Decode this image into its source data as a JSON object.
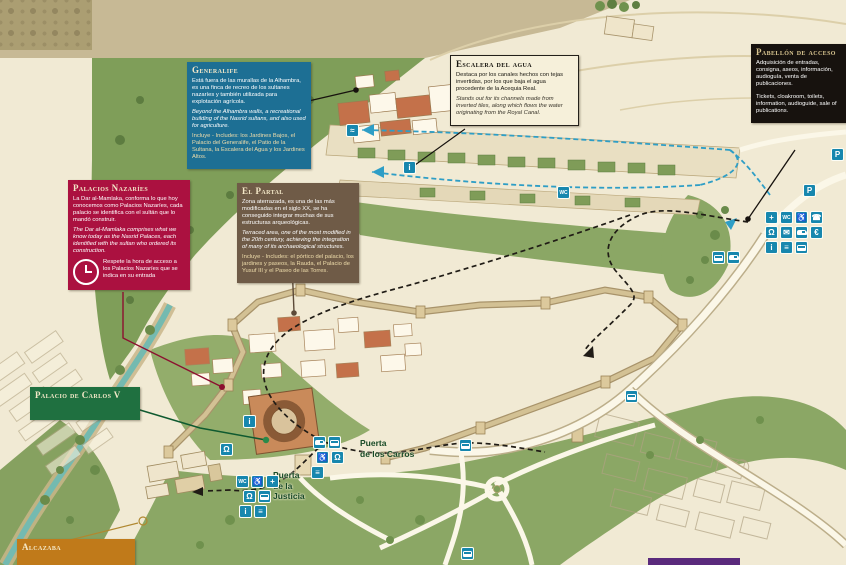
{
  "boxes": {
    "generalife": {
      "title": "Generalife",
      "es": "Está fuera de las murallas de la Alhambra, es una finca de recreo de los sultanes nazaríes y también utilizada para explotación agrícola.",
      "en": "Beyond the Alhambra walls, a recreational building of the Nasrid sultans, and also used for agriculture.",
      "includes": "Incluye - Includes: los Jardines Bajos, el Palacio del Generalife, el Patio de la Sultana, la Escalera del Agua y los Jardines Altos."
    },
    "escalera": {
      "title": "Escalera del agua",
      "es": "Destaca por los canales hechos con tejas invertidas, por los que baja el agua procedente de la Acequia Real.",
      "en": "Stands out for its channels made from inverted tiles, along which flows the water originating from the Royal Canal."
    },
    "pabellon": {
      "title": "Pabellón de acceso",
      "es": "Adquisición de entradas, consigna, aseos, información, audioguía, venta de publicaciones.",
      "en": "Tickets, cloakroom, toilets, information, audioguide, sale of publications."
    },
    "nazaries": {
      "title": "Palacios Nazaríes",
      "es": "La Dar al-Mamlaka, conforma lo que hoy conocemos como Palacios Nazaríes, cada palacio se identifica con el sultán que lo mandó construir.",
      "en": "The Dar al-Mamlaka comprises what we know today as the Nasrid Palaces, each identified with the sultan who ordered its construction.",
      "note": "Respete la hora de acceso a los Palacios Nazaríes que se indica en su entrada"
    },
    "partal": {
      "title": "El Partal",
      "es": "Zona aterrazada, es una de las más modificadas en el siglo XX, se ha conseguido integrar muchas de sus estructuras arqueológicas.",
      "en": "Terraced area, one of the most modified in the 20th century, achieving the integration of many of its archaeological structures.",
      "includes": "Incluye - Includes: el pórtico del palacio, los jardines y paseos, la Rauda, el Palacio de Yusuf III y el Paseo de las Torres."
    },
    "carlos": {
      "title": "Palacio de Carlos V"
    },
    "alcazaba": {
      "title": "Alcazaba"
    }
  },
  "map_labels": {
    "puerta_carros": "Puerta\nde los Carros",
    "puerta_justicia": "Puerta\nde la\nJusticia"
  },
  "colors": {
    "generalife_box": "#1d6f94",
    "escalera_box": "#f6f0da",
    "pabellon_box": "#17120e",
    "nazaries_box": "#ab1140",
    "partal_box": "#6f5b47",
    "carlos_box": "#1f7040",
    "alcazaba_box": "#c07a1a",
    "service_icon_blue": "#1787ae",
    "route_black": "#201c16",
    "route_blue": "#2e9ec6"
  },
  "service_icons": [
    {
      "x": 765,
      "y": 211,
      "g": "+",
      "name": "first-aid-icon"
    },
    {
      "x": 780,
      "y": 211,
      "g": "WC",
      "name": "toilets-icon"
    },
    {
      "x": 795,
      "y": 211,
      "g": "♿",
      "name": "accessibility-icon"
    },
    {
      "x": 810,
      "y": 211,
      "g": "☎",
      "name": "phone-icon"
    },
    {
      "x": 765,
      "y": 226,
      "g": "Ω",
      "name": "audioguide-icon"
    },
    {
      "x": 780,
      "y": 226,
      "g": "✉",
      "name": "mail-icon"
    },
    {
      "x": 795,
      "y": 226,
      "g": "CAR",
      "name": "car-icon"
    },
    {
      "x": 810,
      "y": 226,
      "g": "€",
      "name": "ticket-sales-icon"
    },
    {
      "x": 765,
      "y": 241,
      "g": "i",
      "name": "information-icon"
    },
    {
      "x": 780,
      "y": 241,
      "g": "≡",
      "name": "publications-icon"
    },
    {
      "x": 795,
      "y": 241,
      "g": "BUS",
      "name": "bus-icon"
    },
    {
      "x": 712,
      "y": 251,
      "g": "BUS",
      "name": "bus-icon"
    },
    {
      "x": 727,
      "y": 251,
      "g": "CAR",
      "name": "car-icon"
    },
    {
      "x": 803,
      "y": 184,
      "g": "P",
      "name": "parking-icon"
    },
    {
      "x": 831,
      "y": 148,
      "g": "P",
      "name": "parking-icon"
    },
    {
      "x": 346,
      "y": 124,
      "g": "≈",
      "name": "water-channel-icon"
    },
    {
      "x": 403,
      "y": 161,
      "g": "i",
      "name": "information-icon"
    },
    {
      "x": 557,
      "y": 186,
      "g": "WC",
      "name": "toilets-icon"
    },
    {
      "x": 243,
      "y": 415,
      "g": "i",
      "name": "information-icon"
    },
    {
      "x": 220,
      "y": 443,
      "g": "Ω",
      "name": "audioguide-icon"
    },
    {
      "x": 313,
      "y": 436,
      "g": "CAR",
      "name": "car-icon"
    },
    {
      "x": 328,
      "y": 436,
      "g": "BUS",
      "name": "bus-icon"
    },
    {
      "x": 316,
      "y": 451,
      "g": "♿",
      "name": "accessibility-icon"
    },
    {
      "x": 331,
      "y": 451,
      "g": "Ω",
      "name": "audioguide-icon"
    },
    {
      "x": 311,
      "y": 466,
      "g": "≡",
      "name": "publications-icon"
    },
    {
      "x": 236,
      "y": 475,
      "g": "WC",
      "name": "toilets-icon"
    },
    {
      "x": 251,
      "y": 475,
      "g": "♿",
      "name": "accessibility-icon"
    },
    {
      "x": 266,
      "y": 475,
      "g": "+",
      "name": "first-aid-icon"
    },
    {
      "x": 243,
      "y": 490,
      "g": "Ω",
      "name": "audioguide-icon"
    },
    {
      "x": 258,
      "y": 490,
      "g": "BUS",
      "name": "bus-icon"
    },
    {
      "x": 239,
      "y": 505,
      "g": "i",
      "name": "information-icon"
    },
    {
      "x": 254,
      "y": 505,
      "g": "≡",
      "name": "publications-icon"
    },
    {
      "x": 459,
      "y": 439,
      "g": "BUS",
      "name": "bus-stop-icon"
    },
    {
      "x": 461,
      "y": 547,
      "g": "BUS",
      "name": "bus-stop-icon"
    },
    {
      "x": 625,
      "y": 390,
      "g": "BUS",
      "name": "bus-stop-icon"
    }
  ]
}
